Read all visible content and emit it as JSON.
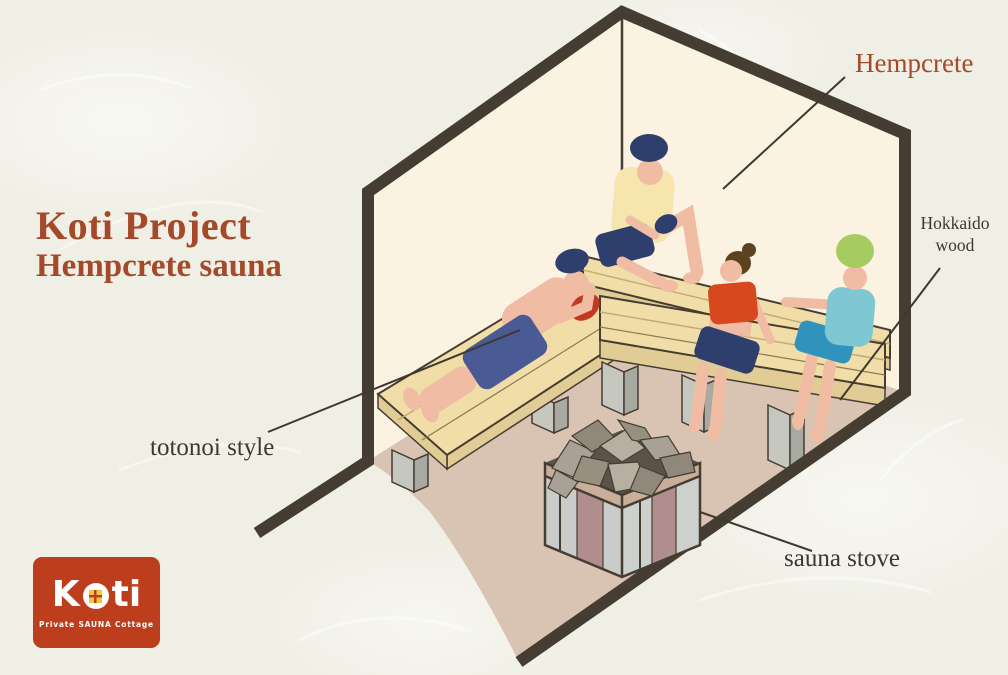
{
  "title": {
    "line1": "Koti Project",
    "line2": "Hempcrete sauna"
  },
  "callouts": {
    "hempcrete": "Hempcrete",
    "hokkaido_wood": "Hokkaido wood",
    "totonoi": "totonoi style",
    "sauna_stove": "sauna stove"
  },
  "logo": {
    "brand_k": "K",
    "brand_ti": "ti",
    "tagline": "Private SAUNA Cottage"
  },
  "scene": {
    "description": "Isometric cutaway illustration of a hempcrete sauna room: four bathers on Hokkaido wood tiered benches around a stone-topped sauna stove, one person lying down in totonoi style",
    "people": [
      {
        "pose": "lying on left bench",
        "hat": "navy beanie",
        "outfit": "blue shorts, red towel"
      },
      {
        "pose": "sitting on upper bench, knee raised",
        "hat": "navy beanie",
        "outfit": "yellow shirt, navy shorts"
      },
      {
        "pose": "sitting on lower bench",
        "hair": "brown bun",
        "outfit": "red top, navy shorts"
      },
      {
        "pose": "sitting on lower bench",
        "hat": "green beanie",
        "outfit": "teal top, blue shorts"
      }
    ]
  },
  "colors": {
    "background": "#F0EFE5",
    "wall": "#FBF2E2",
    "floor": "#D9C3B2",
    "outline": "#453D32",
    "callout": "#3E382E",
    "accent_rust": "#A4492A",
    "label_dark": "#3B3831",
    "logo_bg": "#BC3E1D",
    "logo_window": "#F2C63C",
    "bench_wood": "#F1DDA7",
    "bench_side": "#E2CC96",
    "plank": "#C2A878",
    "plank_dark": "#8B7B55",
    "leg_gray": "#C6C7BF",
    "leg_dark": "#A8A9A1",
    "skin": "#F0BCA4",
    "navy": "#2E3F6E",
    "denim": "#4A5A94",
    "yellow_shirt": "#F7E5AE",
    "red_top": "#D8481F",
    "red_towel": "#C13A20",
    "teal_top": "#7FC7D2",
    "teal_shorts": "#3193BB",
    "green_hat": "#A6CC5F",
    "hair_brown": "#5C431F",
    "stove_panel": "#C9CCC8",
    "stove_panel2": "#CDD0CC",
    "stove_accent": "#B18E8E",
    "stove_frame": "#C9AE9B",
    "stove_top": "#5A5348",
    "stone1": "#A9A195",
    "stone2": "#8F887B",
    "stone3": "#B7AFA2",
    "stone4": "#97907F",
    "texture": "#FFFFFF"
  }
}
